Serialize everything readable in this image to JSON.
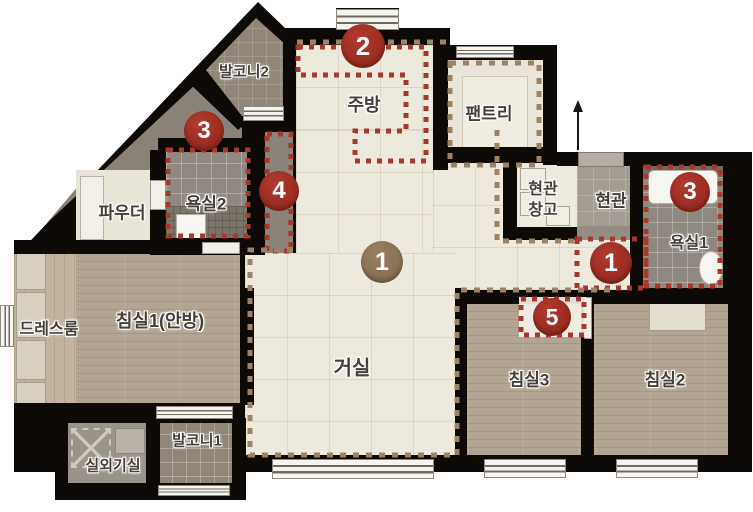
{
  "plan": {
    "rooms": [
      {
        "id": "balcony2",
        "label": "발코니2"
      },
      {
        "id": "kitchen",
        "label": "주방"
      },
      {
        "id": "pantry",
        "label": "팬트리"
      },
      {
        "id": "bath2",
        "label": "욕실2"
      },
      {
        "id": "powder",
        "label": "파우더"
      },
      {
        "id": "entry_storage",
        "label": "현관창고",
        "line1": "현관",
        "line2": "창고"
      },
      {
        "id": "entry",
        "label": "현관"
      },
      {
        "id": "bath1",
        "label": "욕실1"
      },
      {
        "id": "dressroom",
        "label": "드레스룸"
      },
      {
        "id": "bed1",
        "label": "침실1(안방)"
      },
      {
        "id": "living",
        "label": "거실"
      },
      {
        "id": "bed3",
        "label": "침실3"
      },
      {
        "id": "bed2",
        "label": "침실2"
      },
      {
        "id": "balcony1",
        "label": "발코니1"
      },
      {
        "id": "outdoor_unit",
        "label": "실외기실"
      }
    ],
    "markers": [
      {
        "num": "2",
        "color": "red",
        "location": "kitchen-top"
      },
      {
        "num": "3",
        "color": "red",
        "location": "bath2"
      },
      {
        "num": "4",
        "color": "red",
        "location": "passage-strip"
      },
      {
        "num": "1",
        "color": "tan",
        "location": "living-dining"
      },
      {
        "num": "1",
        "color": "red",
        "location": "entry-hall"
      },
      {
        "num": "3",
        "color": "red",
        "location": "bath1"
      },
      {
        "num": "5",
        "color": "red",
        "location": "bed3-wall"
      }
    ],
    "colors": {
      "wall": "#0d0a08",
      "floor_cream": "#ede9dd",
      "wood": "#b2a492",
      "tile_gray": "#8f8678",
      "bath_tile": "#8e8880",
      "marker_red": "#9e2b22",
      "marker_tan": "#8b7257",
      "dotted_red": "#a8372c",
      "dashed_tan": "#9c8365"
    }
  }
}
